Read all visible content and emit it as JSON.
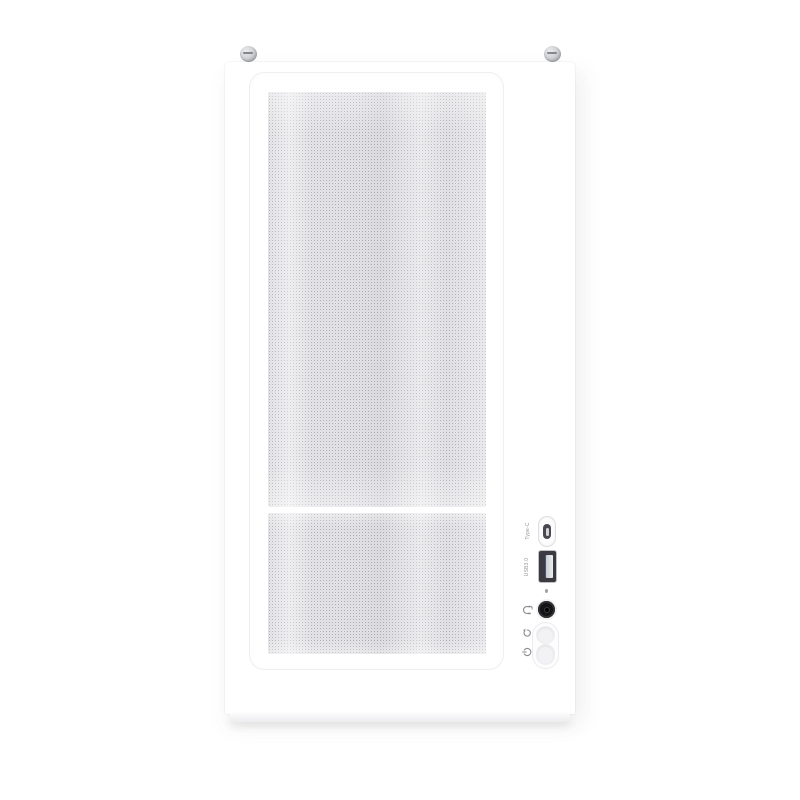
{
  "image": {
    "description": "Front-view product photo of a white mid-tower PC case with a perforated mesh front panel, front I/O ports and two top thumbscrews",
    "background_color": "#ffffff"
  },
  "case": {
    "body_color": "#ffffff",
    "panel_border_color": "#e6e6ea",
    "mesh": {
      "dot_color": "#aaaab0",
      "sections": [
        "top-mesh",
        "bottom-mesh"
      ]
    },
    "hardware": {
      "thumbscrew_count": 2,
      "screw_color": "#b9bac0"
    },
    "io_panel": {
      "typec_label": "Type-C",
      "usb_label": "USB3.0",
      "ports": [
        {
          "name": "usb-typec-port",
          "type": "USB Type-C"
        },
        {
          "name": "usb3-port",
          "type": "USB 3.0",
          "interior_color": "#3a3a40"
        },
        {
          "name": "power-led",
          "color": "#a0a0a6"
        },
        {
          "name": "audio-jack",
          "color": "#141417"
        },
        {
          "name": "reset-button"
        },
        {
          "name": "power-button"
        }
      ],
      "icons": [
        "headset-icon",
        "reset-icon",
        "power-icon"
      ]
    }
  }
}
